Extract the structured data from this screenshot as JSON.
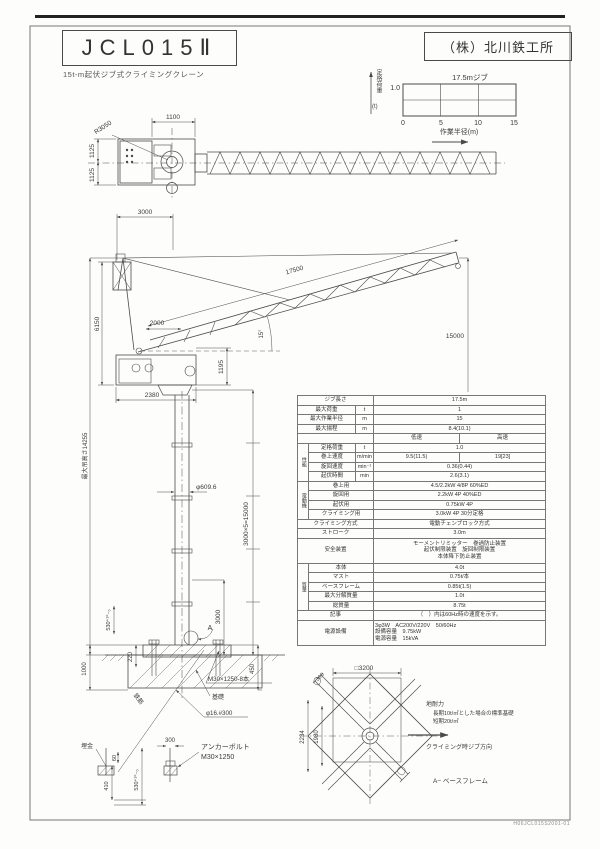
{
  "header": {
    "title": "JCL015Ⅱ",
    "company": "（株）北川鉄工所",
    "subtitle": "15t-m起伏ジブ式クライミングクレーン",
    "drawing_number": "H06JCL015S2001-01"
  },
  "chart_data": {
    "type": "line",
    "title": "17.5mジブ",
    "xlabel": "作業半径(m)",
    "ylabel": "定格荷重(t)",
    "x": [
      0,
      5,
      10,
      15
    ],
    "series": [
      {
        "name": "定格荷重",
        "values": [
          1.0,
          1.0,
          1.0,
          1.0
        ]
      }
    ],
    "xlim": [
      0,
      15
    ],
    "ylim": [
      0,
      1.0
    ],
    "xticks": [
      "0",
      "5",
      "10",
      "15"
    ],
    "grid": true,
    "legend": "none"
  },
  "chart_labels": {
    "title": "17.5mジブ",
    "ymax": "1.0",
    "ylabel": "定格荷重",
    "yunit": "(t)",
    "t0": "0",
    "t5": "5",
    "t10": "10",
    "t15": "15",
    "xlabel": "作業半径(m)"
  },
  "top_view": {
    "r3050": "R3050",
    "d1100": "1100",
    "d1125a": "1125",
    "d1125b": "1125"
  },
  "elevation": {
    "d3000": "3000",
    "d17500": "17500",
    "d6150": "6150",
    "d2000": "2000",
    "angle": "15°",
    "d1195": "1195",
    "d2380": "2380",
    "hook": "最大吊高さ14255",
    "mast": "3000×5=15000",
    "dia": "φ609.6",
    "d15000": "15000",
    "d530": "530⁺¹⁰₋₀",
    "d3000b": "3000",
    "marker_a": "A"
  },
  "foundation": {
    "d1000": "1000",
    "d220": "220",
    "d450": "450",
    "bolt": "M30×1250-8本",
    "kiso": "基礎",
    "rebar_spec": "φ16.#300",
    "rebar": "鉄筋"
  },
  "anchor": {
    "umegane": "埋金",
    "d60": "60",
    "d410": "410",
    "d530": "530⁺¹⁰₋₀",
    "d300": "300",
    "line1": "アンカーボルト",
    "line2": "M30×1250"
  },
  "plan": {
    "sq": "□3200",
    "d2234": "2234",
    "d1980": "1980",
    "d300": "300",
    "note1": "地耐力",
    "note2": "長期10t/㎡とした場合の標準基礎",
    "note3": "短期20t/㎡",
    "direction": "クライミング時ジブ方向",
    "caption": "A− ベースフレーム"
  },
  "spec": {
    "r1_label": "ジブ長さ",
    "r1_value": "17.5m",
    "r2_label": "最大荷重",
    "r2_unit": "t",
    "r2_value": "1",
    "r3_label": "最大作業半径",
    "r3_unit": "m",
    "r3_value": "15",
    "r4_label": "最大揚程",
    "r4_unit": "m",
    "r4_value": "8.4(10.1)",
    "perf_group": "性能",
    "speed_low": "低速",
    "speed_high": "高速",
    "r6_label": "定格荷重",
    "r6_unit": "t",
    "r6_value": "1.0",
    "r7_label": "巻上速度",
    "r7_unit": "m/min",
    "r7_low": "9.5(11.5)",
    "r7_high": "19[23]",
    "r8_label": "旋回速度",
    "r8_unit": "min⁻¹",
    "r8_value": "0.36(0.44)",
    "r9_label": "起伏時間",
    "r9_unit": "min",
    "r9_value": "2.6(3.1)",
    "motor_group": "電動機",
    "r10_label": "巻上用",
    "r10_value": "4.5/2.2kW 4/8P 60%ED",
    "r11_label": "旋回用",
    "r11_value": "2.2kW 4P 40%ED",
    "r12_label": "起伏用",
    "r12_value": "0.75kW 4P",
    "r13_label": "クライミング用",
    "r13_value": "3.0kW 4P 30分定格",
    "r14_label": "クライミング方式",
    "r14_value": "電動チェンブロック方式",
    "r15_label": "ストローク",
    "r15_value": "3.0m",
    "safety_label": "安全装置",
    "safety_line1": "モーメントリミッター　巻過防止装置",
    "safety_line2": "起伏制限装置　旋回制限装置",
    "safety_line3": "本体降下防止装置",
    "mass_group": "質量",
    "r17_label": "本体",
    "r17_value": "4.0t",
    "r18_label": "マスト",
    "r18_value": "0.75t/本",
    "r19_label": "ベースフレーム",
    "r19_value": "0.85t(1.5)",
    "r20_label": "最大分解質量",
    "r20_value": "1.0t",
    "r21_label": "総質量",
    "r21_value": "8.75t",
    "note_label": "記事",
    "note_value": "（　）内は60Hz時の速度を示す。",
    "power_label": "電源設備",
    "power_line1": "3φ3W　AC200V/220V　50/60Hz",
    "power_line2": "設備容量　9.75kW",
    "power_line3": "電源容量　15kVA"
  }
}
